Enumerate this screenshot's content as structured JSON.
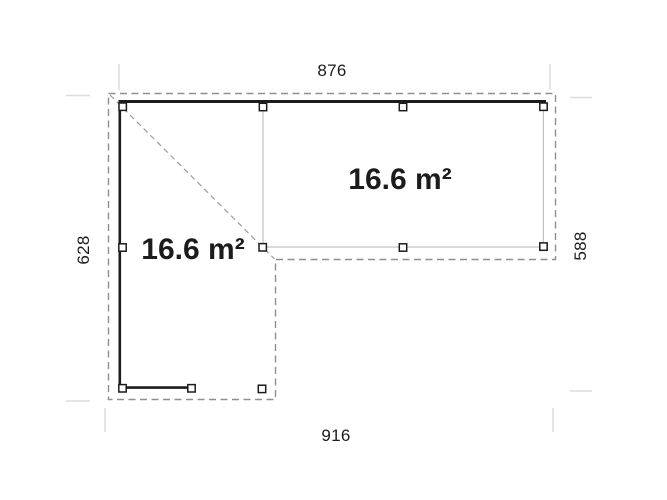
{
  "plan": {
    "dim_top": "876",
    "dim_bottom": "916",
    "dim_left": "628",
    "dim_right": "588",
    "area_left_wing": "16.6 m²",
    "area_right_wing": "16.6 m²"
  },
  "colors": {
    "background": "#ffffff",
    "wall": "#1c1c1c",
    "post_fill": "#ffffff",
    "roof_dash": "#8f8f8f",
    "diagonal_dash": "#9a9a9a",
    "thin_frame": "#b3b3b3",
    "extension_tick": "#dcdcdc",
    "text": "#1c1c1c"
  }
}
